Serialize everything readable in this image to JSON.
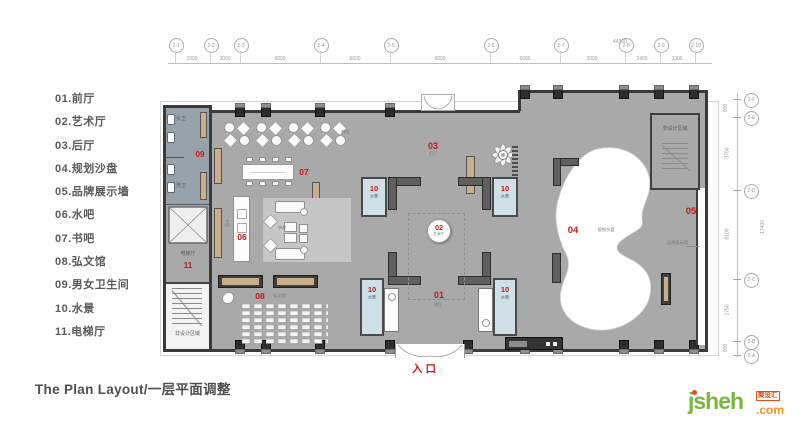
{
  "legend": {
    "items": [
      "01.前厅",
      "02.艺术厅",
      "03.后厅",
      "04.规划沙盘",
      "05.品牌展示墙",
      "06.水吧",
      "07.书吧",
      "08.弘文馆",
      "09.男女卫生间",
      "10.水景",
      "11.电梯厅"
    ]
  },
  "title": "The Plan Layout/一层平面调整",
  "entrance_label": "入口",
  "rooms": {
    "r01": {
      "num": "01",
      "name": "前厅"
    },
    "r02": {
      "num": "02",
      "name": "艺术厅"
    },
    "r03": {
      "num": "03",
      "name": "后厅"
    },
    "r04": {
      "num": "04",
      "name": "规划沙盘"
    },
    "r05": {
      "num": "05",
      "name": "品牌展示墙"
    },
    "r06": {
      "num": "06",
      "name": "水吧"
    },
    "r07": {
      "num": "07",
      "name": "书吧"
    },
    "r08": {
      "num": "08",
      "name": "弘文馆"
    },
    "r09": {
      "num": "09",
      "women": "女卫",
      "men": "男卫"
    },
    "r10": {
      "num": "10",
      "name": "水景"
    },
    "r11": {
      "num": "11",
      "name": "电梯厅"
    }
  },
  "annotations": {
    "non_design": "非设计区域"
  },
  "grid": {
    "top_bubbles": [
      "2-1",
      "2-2",
      "2-3",
      "2-4",
      "2-5",
      "2-6",
      "2-7",
      "2-8",
      "2-9",
      "2-10"
    ],
    "top_dims": [
      "3300",
      "3000",
      "6600",
      "6600",
      "6600",
      "6600",
      "3000",
      "2400",
      "3300"
    ],
    "top_overall": "44300",
    "right_bubbles": [
      "2-F",
      "2-E",
      "2-D",
      "2-C",
      "2-B",
      "2-A"
    ],
    "right_dims": [
      "900",
      "3750",
      "8100",
      "3750",
      "900"
    ],
    "right_overall": "17400"
  },
  "logo": {
    "name": "jsheh",
    "tld": ".com",
    "badge": "聚设汇"
  },
  "colors": {
    "floor": "#a9a9a9",
    "wall": "#3a3a3a",
    "water": "#cfe0e6",
    "restroom": "#98a2ab",
    "accent_red": "#c01818",
    "logo_green": "#7ab63d",
    "logo_orange": "#f6921e"
  }
}
